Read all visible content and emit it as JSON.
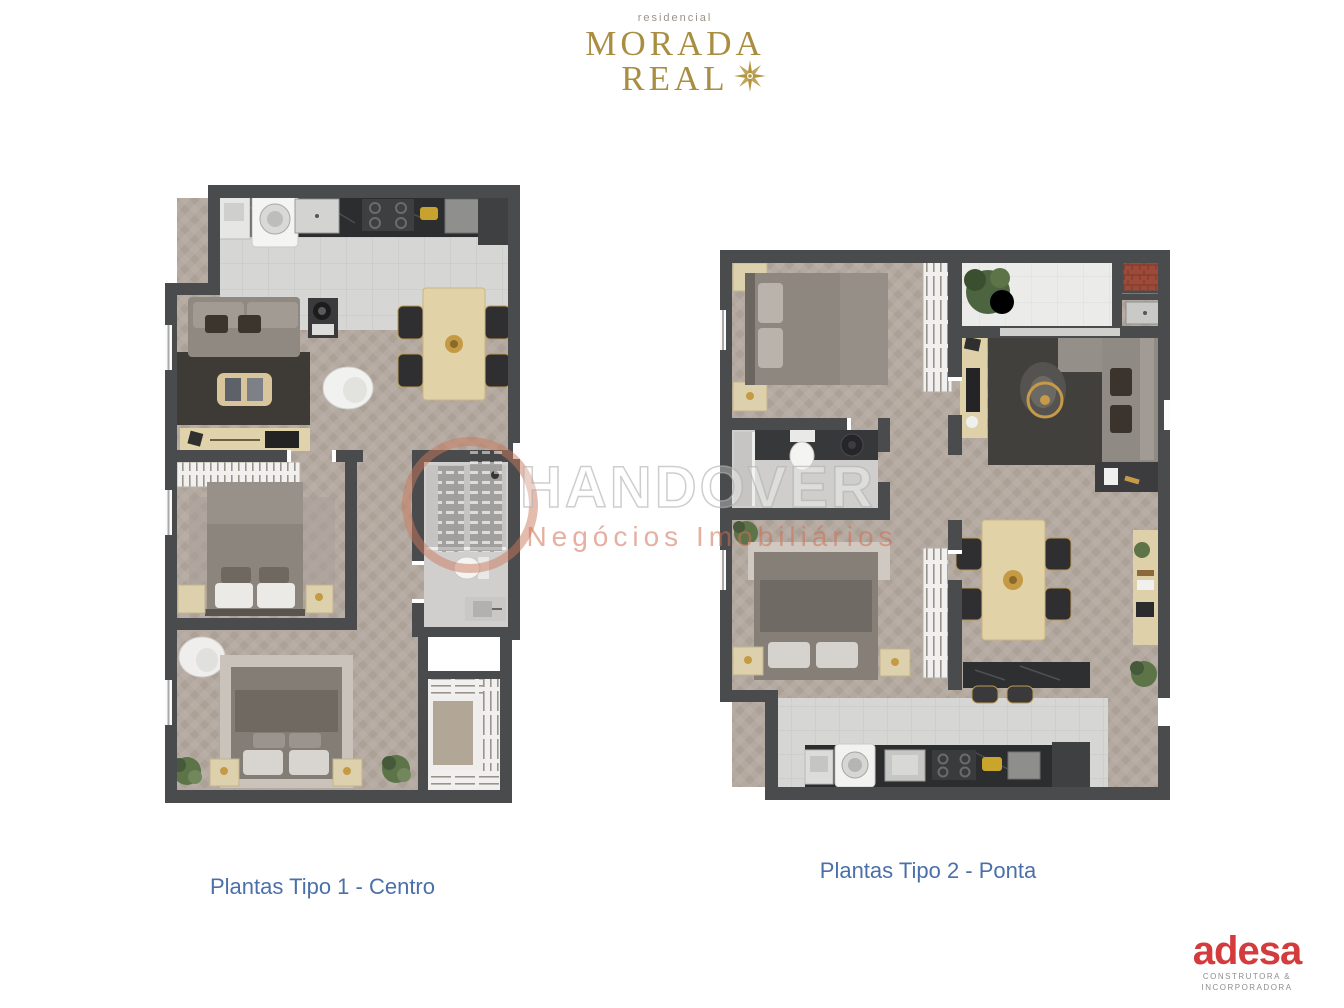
{
  "logo": {
    "brand_top": "residencial",
    "brand_line1": "MORADA",
    "brand_line2": "REAL",
    "color": "#a98e42"
  },
  "watermark": {
    "name": "HANDOVER",
    "tagline": "Negócios Imobiliários",
    "accent": "#cf8b6e"
  },
  "captions": {
    "plan1": "Plantas Tipo 1 - Centro",
    "plan2": "Plantas Tipo 2 - Ponta",
    "color": "#4b70a8"
  },
  "footer_logo": {
    "name": "adesa",
    "subtitle_line1": "CONSTRUTORA &",
    "subtitle_line2": "INCORPORADORA",
    "color": "#d43b3d"
  }
}
